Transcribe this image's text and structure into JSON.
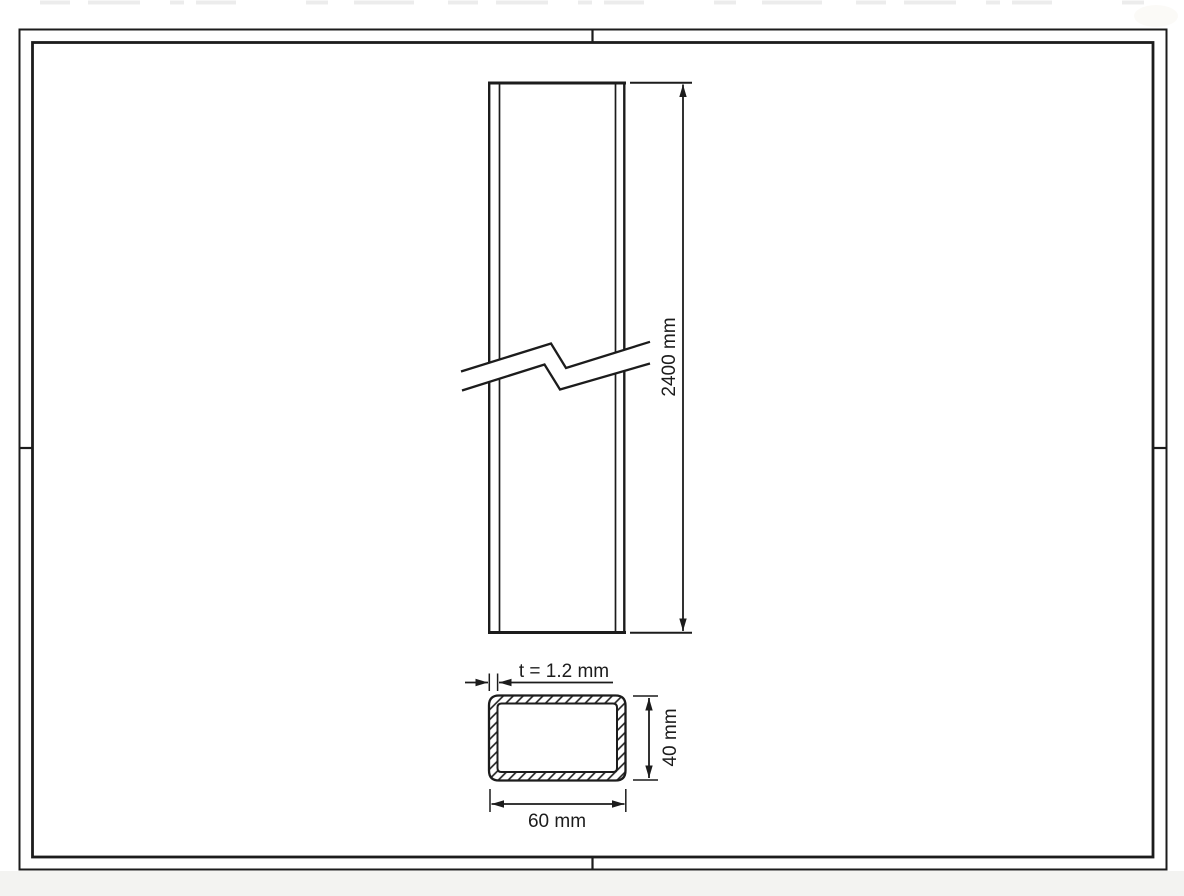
{
  "drawing": {
    "dimensions": {
      "length": "2400 mm",
      "thickness": "t = 1.2 mm",
      "section_height": "40 mm",
      "section_width": "60 mm"
    }
  },
  "colors": {
    "line": "#1c1c1c",
    "paper": "#ffffff",
    "bottom_margin": "#f3f3f1"
  }
}
